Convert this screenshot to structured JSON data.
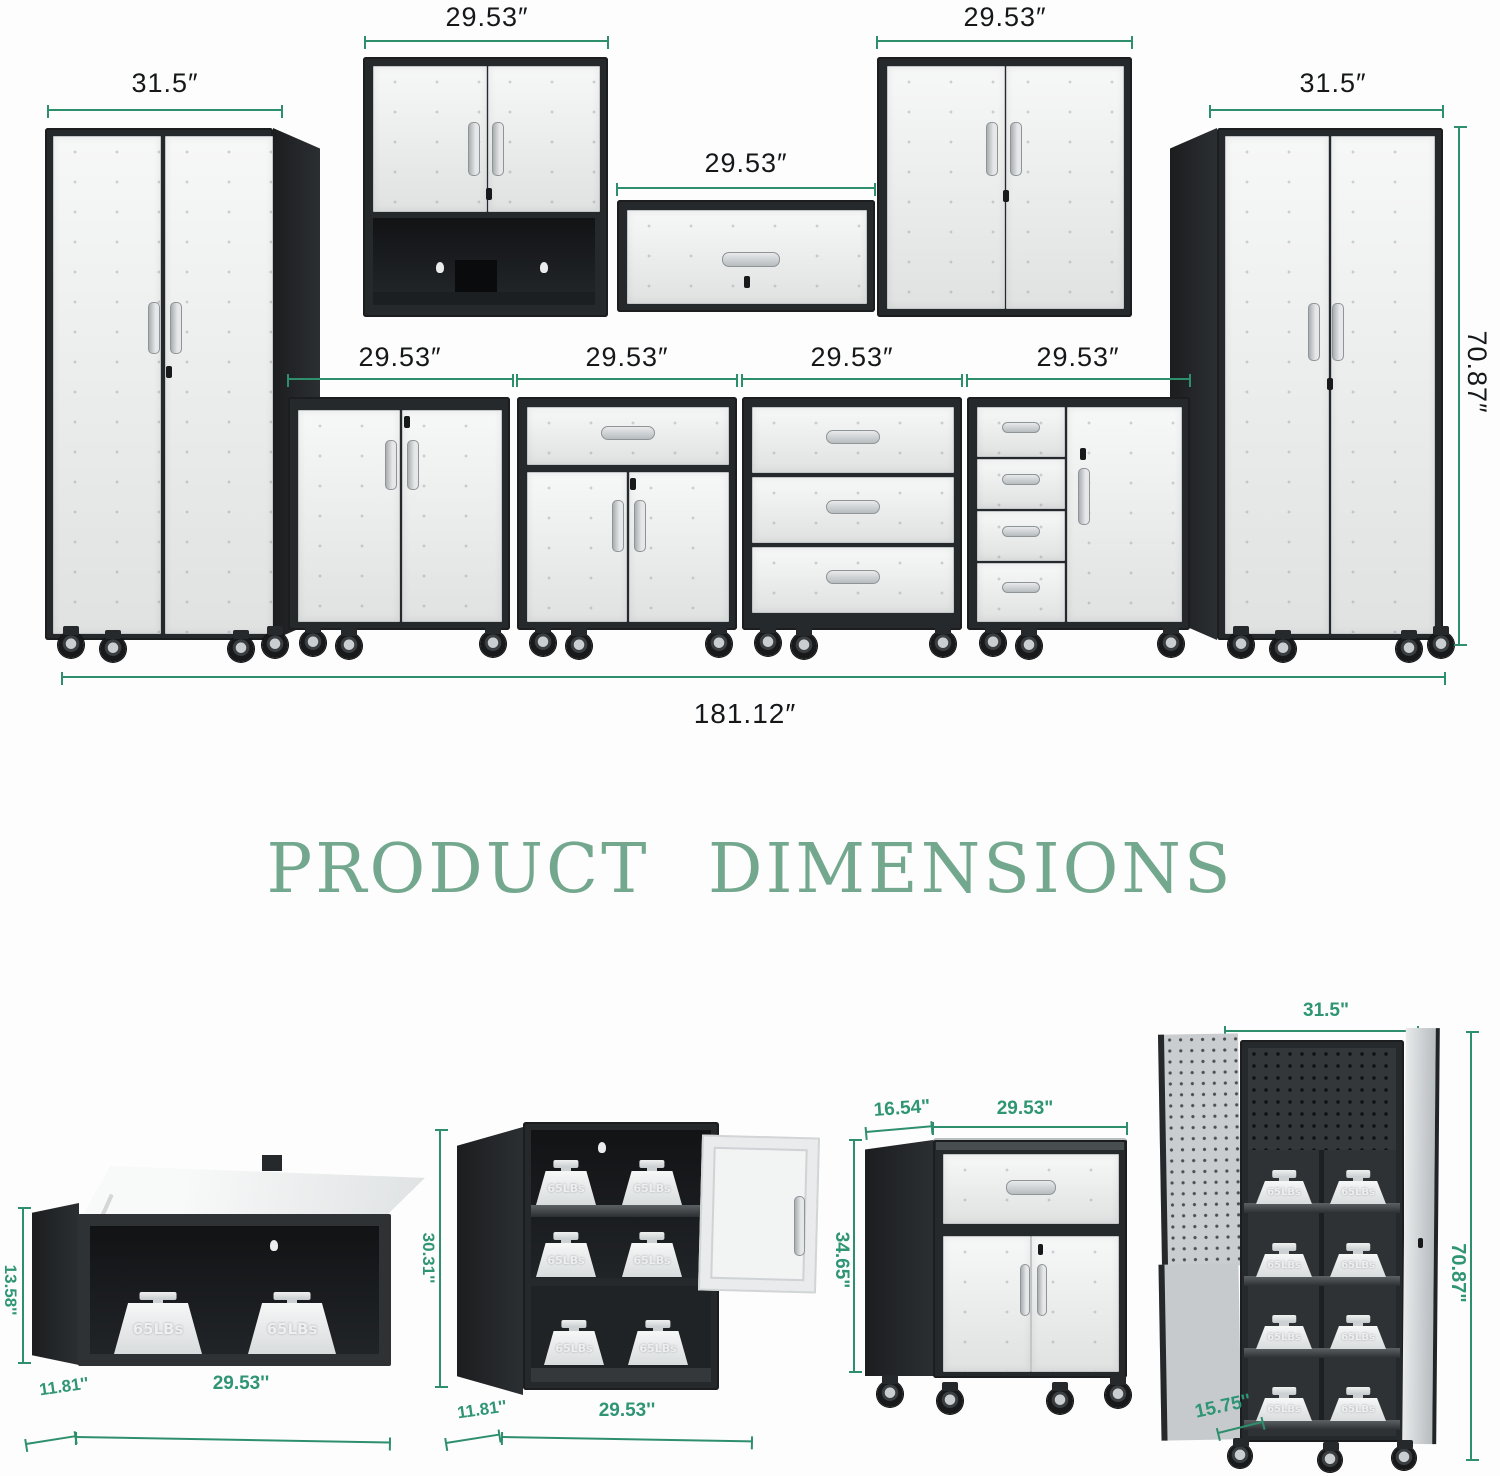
{
  "title": "PRODUCT DIMENSIONS",
  "colors": {
    "dimension_line_green": "#2e8f6d",
    "detail_label_green": "#2f9574",
    "title_green": "#74a88e",
    "cabinet_frame_dark": "#26292c",
    "door_light_gray": "#eceeee"
  },
  "overview": {
    "left_tall_cabinet_width": "31.5″",
    "wall_cabinet_left_width": "29.53″",
    "wall_cabinet_middle_width": "29.53″",
    "wall_cabinet_right_width": "29.53″",
    "right_tall_cabinet_width": "31.5″",
    "right_tall_cabinet_height": "70.87″",
    "base_cabinet_1_width": "29.53″",
    "base_cabinet_2_width": "29.53″",
    "base_cabinet_3_width": "29.53″",
    "base_cabinet_4_width": "29.53″",
    "total_width": "181.12″"
  },
  "details": {
    "flip_up_wall_cabinet": {
      "height": "13.58''",
      "depth": "11.81''",
      "width": "29.53''"
    },
    "two_tier_wall_cabinet": {
      "height": "30.31''",
      "depth": "11.81''",
      "width": "29.53''"
    },
    "rolling_cabinet": {
      "depth": "16.54\"",
      "width": "29.53\"",
      "height": "34.65\""
    },
    "tall_cabinet": {
      "width": "31.5\"",
      "height": "70.87\"",
      "depth": "15.75''"
    }
  },
  "weight_label": "65LBs"
}
